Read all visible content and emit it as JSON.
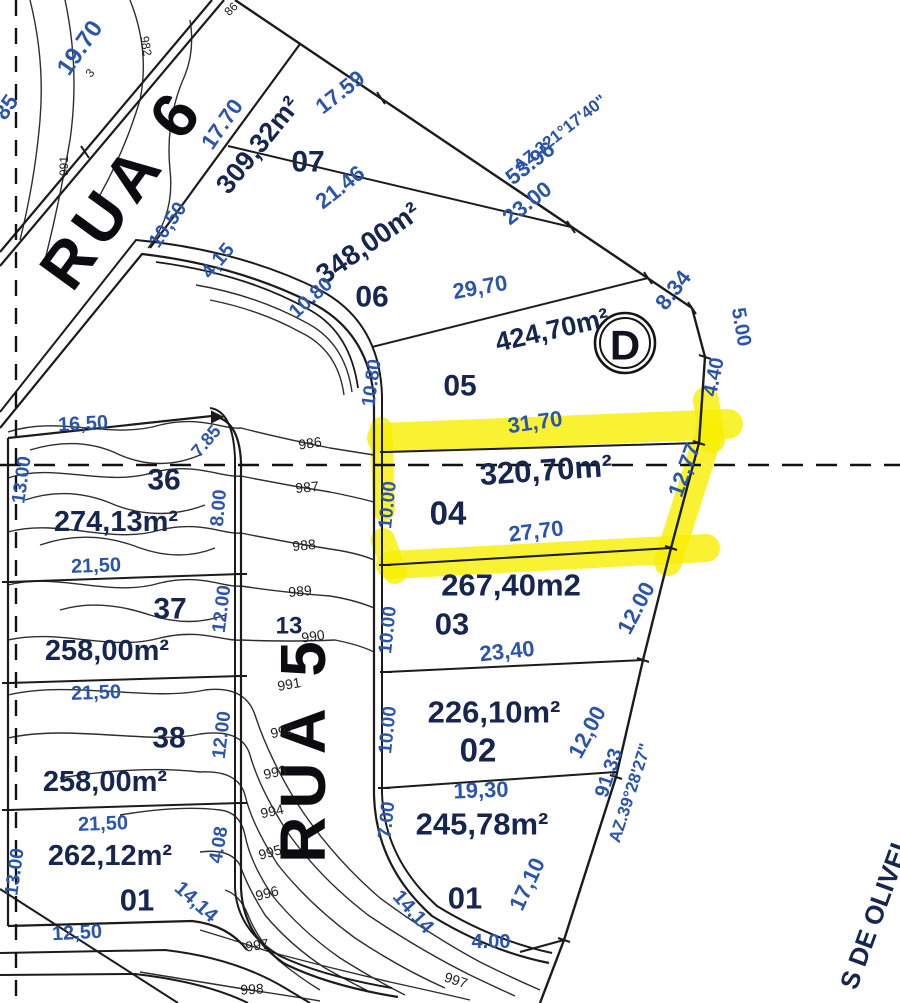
{
  "map_title": "Loteamento site plan with contour lines and highlighted lot 04",
  "streets": [
    {
      "name": "RUA 6"
    },
    {
      "name": "RUA 5"
    }
  ],
  "boundary_street_fragment": "S DE OLIVEI",
  "survey_point": {
    "label": "D"
  },
  "azimuths": [
    "AZ.321°17'40\"",
    "AZ.39°28'27\""
  ],
  "highlighted_lot": {
    "number": "04",
    "area": "320,70m²",
    "front": "31,70",
    "back": "27,70",
    "side_right": "12,77",
    "side_left": "10.00",
    "highlight_color": "#f7ef00"
  },
  "lots": [
    {
      "number": "07",
      "area": "309,32m²"
    },
    {
      "number": "06",
      "area": "348,00m²"
    },
    {
      "number": "05",
      "area": "424,70m²"
    },
    {
      "number": "04",
      "area": "320,70m²"
    },
    {
      "number": "03",
      "area": "267,40m2"
    },
    {
      "number": "02",
      "area": "226,10m²"
    },
    {
      "number": "01",
      "area": "245,78m²"
    },
    {
      "number": "36",
      "area": "274,13m²"
    },
    {
      "number": "37",
      "area": "258,00m²"
    },
    {
      "number": "38",
      "area": "258,00m²"
    },
    {
      "number": "01",
      "area": "262,12m²"
    }
  ],
  "contour_elevations": [
    "982",
    "986",
    "987",
    "988",
    "989",
    "990",
    "991",
    "992",
    "993",
    "994",
    "995",
    "996",
    "997",
    "998"
  ],
  "labels": [
    {
      "t": "RUA 6",
      "x": 122,
      "y": 188,
      "r": -54,
      "s": 64,
      "c": "street",
      "ls": 8,
      "n": "street-label-rua-6"
    },
    {
      "t": "RUA 5",
      "x": 303,
      "y": 748,
      "r": -90,
      "s": 64,
      "c": "street",
      "ls": 8,
      "n": "street-label-rua-5"
    },
    {
      "t": "309,32m²",
      "x": 258,
      "y": 145,
      "r": -51,
      "s": 27,
      "c": "area",
      "n": "lot-07-area"
    },
    {
      "t": "348,00m²",
      "x": 368,
      "y": 243,
      "r": -35,
      "s": 28,
      "c": "area",
      "n": "lot-06-area"
    },
    {
      "t": "424,70m²",
      "x": 552,
      "y": 330,
      "r": -13,
      "s": 27,
      "c": "area",
      "n": "lot-05-area"
    },
    {
      "t": "320,70m²",
      "x": 546,
      "y": 470,
      "r": -4,
      "s": 31,
      "c": "area",
      "n": "lot-04-area"
    },
    {
      "t": "267,40m2",
      "x": 511,
      "y": 585,
      "r": 0,
      "s": 31,
      "c": "area",
      "n": "lot-03-area"
    },
    {
      "t": "226,10m²",
      "x": 494,
      "y": 712,
      "r": 0,
      "s": 31,
      "c": "area",
      "n": "lot-02-area"
    },
    {
      "t": "245,78m²",
      "x": 482,
      "y": 824,
      "r": 0,
      "s": 31,
      "c": "area",
      "n": "lot-01-area"
    },
    {
      "t": "274,13m²",
      "x": 116,
      "y": 522,
      "r": 0,
      "s": 29,
      "c": "area",
      "n": "lot-36-area"
    },
    {
      "t": "258,00m²",
      "x": 107,
      "y": 651,
      "r": 0,
      "s": 29,
      "c": "area",
      "n": "lot-37-area"
    },
    {
      "t": "258,00m²",
      "x": 105,
      "y": 782,
      "r": 0,
      "s": 29,
      "c": "area",
      "n": "lot-38-area"
    },
    {
      "t": "262,12m²",
      "x": 110,
      "y": 856,
      "r": 0,
      "s": 29,
      "c": "area",
      "n": "lot-01-left-area"
    },
    {
      "t": "S DE OLIVEI",
      "x": 874,
      "y": 916,
      "r": -70,
      "s": 26,
      "c": "area",
      "n": "boundary-street-label"
    },
    {
      "t": "07",
      "x": 308,
      "y": 162,
      "r": 0,
      "s": 30,
      "c": "lot",
      "n": "lot-number-07"
    },
    {
      "t": "06",
      "x": 372,
      "y": 297,
      "r": 0,
      "s": 30,
      "c": "lot",
      "n": "lot-number-06"
    },
    {
      "t": "05",
      "x": 460,
      "y": 386,
      "r": 0,
      "s": 30,
      "c": "lot",
      "n": "lot-number-05"
    },
    {
      "t": "04",
      "x": 448,
      "y": 513,
      "r": 0,
      "s": 33,
      "c": "lot",
      "n": "lot-number-04"
    },
    {
      "t": "03",
      "x": 452,
      "y": 624,
      "r": 0,
      "s": 31,
      "c": "lot",
      "n": "lot-number-03"
    },
    {
      "t": "02",
      "x": 478,
      "y": 750,
      "r": 0,
      "s": 33,
      "c": "lot",
      "n": "lot-number-02"
    },
    {
      "t": "01",
      "x": 465,
      "y": 898,
      "r": 0,
      "s": 31,
      "c": "lot",
      "n": "lot-number-01"
    },
    {
      "t": "36",
      "x": 164,
      "y": 480,
      "r": 0,
      "s": 30,
      "c": "lot",
      "n": "lot-number-36"
    },
    {
      "t": "37",
      "x": 170,
      "y": 609,
      "r": 0,
      "s": 30,
      "c": "lot",
      "n": "lot-number-37"
    },
    {
      "t": "38",
      "x": 169,
      "y": 738,
      "r": 0,
      "s": 30,
      "c": "lot",
      "n": "lot-number-38"
    },
    {
      "t": "01",
      "x": 137,
      "y": 900,
      "r": 0,
      "s": 31,
      "c": "lot",
      "n": "lot-number-01-left"
    },
    {
      "t": "13",
      "x": 289,
      "y": 626,
      "r": 0,
      "s": 24,
      "c": "lot",
      "n": "lot-number-13"
    },
    {
      "t": "19.70",
      "x": 80,
      "y": 48,
      "r": -55,
      "s": 24,
      "c": "dim"
    },
    {
      "t": "17.70",
      "x": 222,
      "y": 124,
      "r": -55,
      "s": 22,
      "c": "dim"
    },
    {
      "t": "17.59",
      "x": 340,
      "y": 92,
      "r": -38,
      "s": 22,
      "c": "dim"
    },
    {
      "t": "21.46",
      "x": 340,
      "y": 187,
      "r": -38,
      "s": 22,
      "c": "dim"
    },
    {
      "t": "10,50",
      "x": 168,
      "y": 225,
      "r": -55,
      "s": 20,
      "c": "dim"
    },
    {
      "t": "4,15",
      "x": 218,
      "y": 261,
      "r": -50,
      "s": 20,
      "c": "dim"
    },
    {
      "t": "10.80",
      "x": 311,
      "y": 298,
      "r": -42,
      "s": 20,
      "c": "dim"
    },
    {
      "t": "29,70",
      "x": 480,
      "y": 287,
      "r": -10,
      "s": 22,
      "c": "dim"
    },
    {
      "t": "53.96",
      "x": 530,
      "y": 163,
      "r": -38,
      "s": 22,
      "c": "dim"
    },
    {
      "t": "23.00",
      "x": 527,
      "y": 203,
      "r": -38,
      "s": 22,
      "c": "dim"
    },
    {
      "t": "8.34",
      "x": 673,
      "y": 290,
      "r": -52,
      "s": 22,
      "c": "dim"
    },
    {
      "t": "5.00",
      "x": 741,
      "y": 327,
      "r": 80,
      "s": 20,
      "c": "dim"
    },
    {
      "t": "4.40",
      "x": 714,
      "y": 377,
      "r": -78,
      "s": 20,
      "c": "dim"
    },
    {
      "t": "31,70",
      "x": 535,
      "y": 422,
      "r": -8,
      "s": 22,
      "c": "dim"
    },
    {
      "t": "12,77",
      "x": 684,
      "y": 470,
      "r": -70,
      "s": 22,
      "c": "dim"
    },
    {
      "t": "27,70",
      "x": 536,
      "y": 531,
      "r": -7,
      "s": 22,
      "c": "dim"
    },
    {
      "t": "10.80",
      "x": 372,
      "y": 383,
      "r": -82,
      "s": 19,
      "c": "dim"
    },
    {
      "t": "10.00",
      "x": 388,
      "y": 505,
      "r": -84,
      "s": 19,
      "c": "dim"
    },
    {
      "t": "10.00",
      "x": 388,
      "y": 630,
      "r": -84,
      "s": 19,
      "c": "dim"
    },
    {
      "t": "10.00",
      "x": 388,
      "y": 730,
      "r": -84,
      "s": 19,
      "c": "dim"
    },
    {
      "t": "7.00",
      "x": 387,
      "y": 820,
      "r": -84,
      "s": 19,
      "c": "dim"
    },
    {
      "t": "23,40",
      "x": 507,
      "y": 651,
      "r": -6,
      "s": 22,
      "c": "dim"
    },
    {
      "t": "12.00",
      "x": 636,
      "y": 608,
      "r": -62,
      "s": 22,
      "c": "dim"
    },
    {
      "t": "12,00",
      "x": 587,
      "y": 732,
      "r": -62,
      "s": 22,
      "c": "dim"
    },
    {
      "t": "19,30",
      "x": 481,
      "y": 790,
      "r": -2,
      "s": 22,
      "c": "dim"
    },
    {
      "t": "91.33",
      "x": 609,
      "y": 773,
      "r": -72,
      "s": 20,
      "c": "dim"
    },
    {
      "t": "17,10",
      "x": 527,
      "y": 884,
      "r": -65,
      "s": 22,
      "c": "dim"
    },
    {
      "t": "14,14",
      "x": 413,
      "y": 912,
      "r": 48,
      "s": 20,
      "c": "dim"
    },
    {
      "t": "4.00",
      "x": 491,
      "y": 942,
      "r": 0,
      "s": 20,
      "c": "dim"
    },
    {
      "t": "16,50",
      "x": 83,
      "y": 424,
      "r": -3,
      "s": 20,
      "c": "dim"
    },
    {
      "t": "13.00",
      "x": 22,
      "y": 480,
      "r": -82,
      "s": 19,
      "c": "dim"
    },
    {
      "t": "7.85",
      "x": 206,
      "y": 441,
      "r": -50,
      "s": 18,
      "c": "dim"
    },
    {
      "t": "8.00",
      "x": 219,
      "y": 508,
      "r": -85,
      "s": 19,
      "c": "dim"
    },
    {
      "t": "21,50",
      "x": 96,
      "y": 566,
      "r": -2,
      "s": 20,
      "c": "dim"
    },
    {
      "t": "12.00",
      "x": 222,
      "y": 609,
      "r": -83,
      "s": 19,
      "c": "dim"
    },
    {
      "t": "21,50",
      "x": 96,
      "y": 693,
      "r": -2,
      "s": 20,
      "c": "dim"
    },
    {
      "t": "12.00",
      "x": 222,
      "y": 735,
      "r": -83,
      "s": 19,
      "c": "dim"
    },
    {
      "t": "21,50",
      "x": 103,
      "y": 824,
      "r": -2,
      "s": 20,
      "c": "dim"
    },
    {
      "t": "13.00",
      "x": 15,
      "y": 872,
      "r": -82,
      "s": 19,
      "c": "dim"
    },
    {
      "t": "12,50",
      "x": 77,
      "y": 933,
      "r": -3,
      "s": 20,
      "c": "dim"
    },
    {
      "t": "4.08",
      "x": 219,
      "y": 845,
      "r": -80,
      "s": 19,
      "c": "dim"
    },
    {
      "t": "14,14",
      "x": 196,
      "y": 902,
      "r": 42,
      "s": 20,
      "c": "dim"
    },
    {
      "t": "85",
      "x": 6,
      "y": 107,
      "r": -55,
      "s": 22,
      "c": "dim"
    },
    {
      "t": "AZ.321°17'40\"",
      "x": 560,
      "y": 133,
      "r": -38,
      "s": 17,
      "c": "az",
      "n": "azimuth-label-1"
    },
    {
      "t": "AZ.39°28'27\"",
      "x": 630,
      "y": 793,
      "r": -72,
      "s": 17,
      "c": "az",
      "n": "azimuth-label-2"
    },
    {
      "t": "986",
      "x": 310,
      "y": 443,
      "r": -8,
      "s": 14,
      "c": "contour"
    },
    {
      "t": "987",
      "x": 307,
      "y": 487,
      "r": -5,
      "s": 14,
      "c": "contour"
    },
    {
      "t": "988",
      "x": 304,
      "y": 545,
      "r": -5,
      "s": 14,
      "c": "contour"
    },
    {
      "t": "989",
      "x": 300,
      "y": 591,
      "r": -5,
      "s": 14,
      "c": "contour"
    },
    {
      "t": "990",
      "x": 313,
      "y": 636,
      "r": -8,
      "s": 14,
      "c": "contour"
    },
    {
      "t": "991",
      "x": 289,
      "y": 684,
      "r": -10,
      "s": 14,
      "c": "contour"
    },
    {
      "t": "992",
      "x": 282,
      "y": 731,
      "r": -12,
      "s": 14,
      "c": "contour"
    },
    {
      "t": "993",
      "x": 275,
      "y": 772,
      "r": -12,
      "s": 14,
      "c": "contour"
    },
    {
      "t": "994",
      "x": 272,
      "y": 811,
      "r": -12,
      "s": 14,
      "c": "contour"
    },
    {
      "t": "995",
      "x": 270,
      "y": 852,
      "r": -15,
      "s": 14,
      "c": "contour"
    },
    {
      "t": "996",
      "x": 267,
      "y": 893,
      "r": -15,
      "s": 14,
      "c": "contour"
    },
    {
      "t": "997",
      "x": 257,
      "y": 945,
      "r": -8,
      "s": 14,
      "c": "contour"
    },
    {
      "t": "997",
      "x": 456,
      "y": 980,
      "r": 18,
      "s": 14,
      "c": "contour"
    },
    {
      "t": "998",
      "x": 252,
      "y": 989,
      "r": -3,
      "s": 14,
      "c": "contour"
    },
    {
      "t": "982",
      "x": 146,
      "y": 46,
      "r": 80,
      "s": 12,
      "c": "contour"
    },
    {
      "t": "3",
      "x": 90,
      "y": 73,
      "r": -50,
      "s": 12,
      "c": "contour"
    },
    {
      "t": "991",
      "x": 64,
      "y": 166,
      "r": -90,
      "s": 12,
      "c": "contour"
    },
    {
      "t": "86",
      "x": 231,
      "y": 9,
      "r": -45,
      "s": 12,
      "c": "contour"
    }
  ]
}
